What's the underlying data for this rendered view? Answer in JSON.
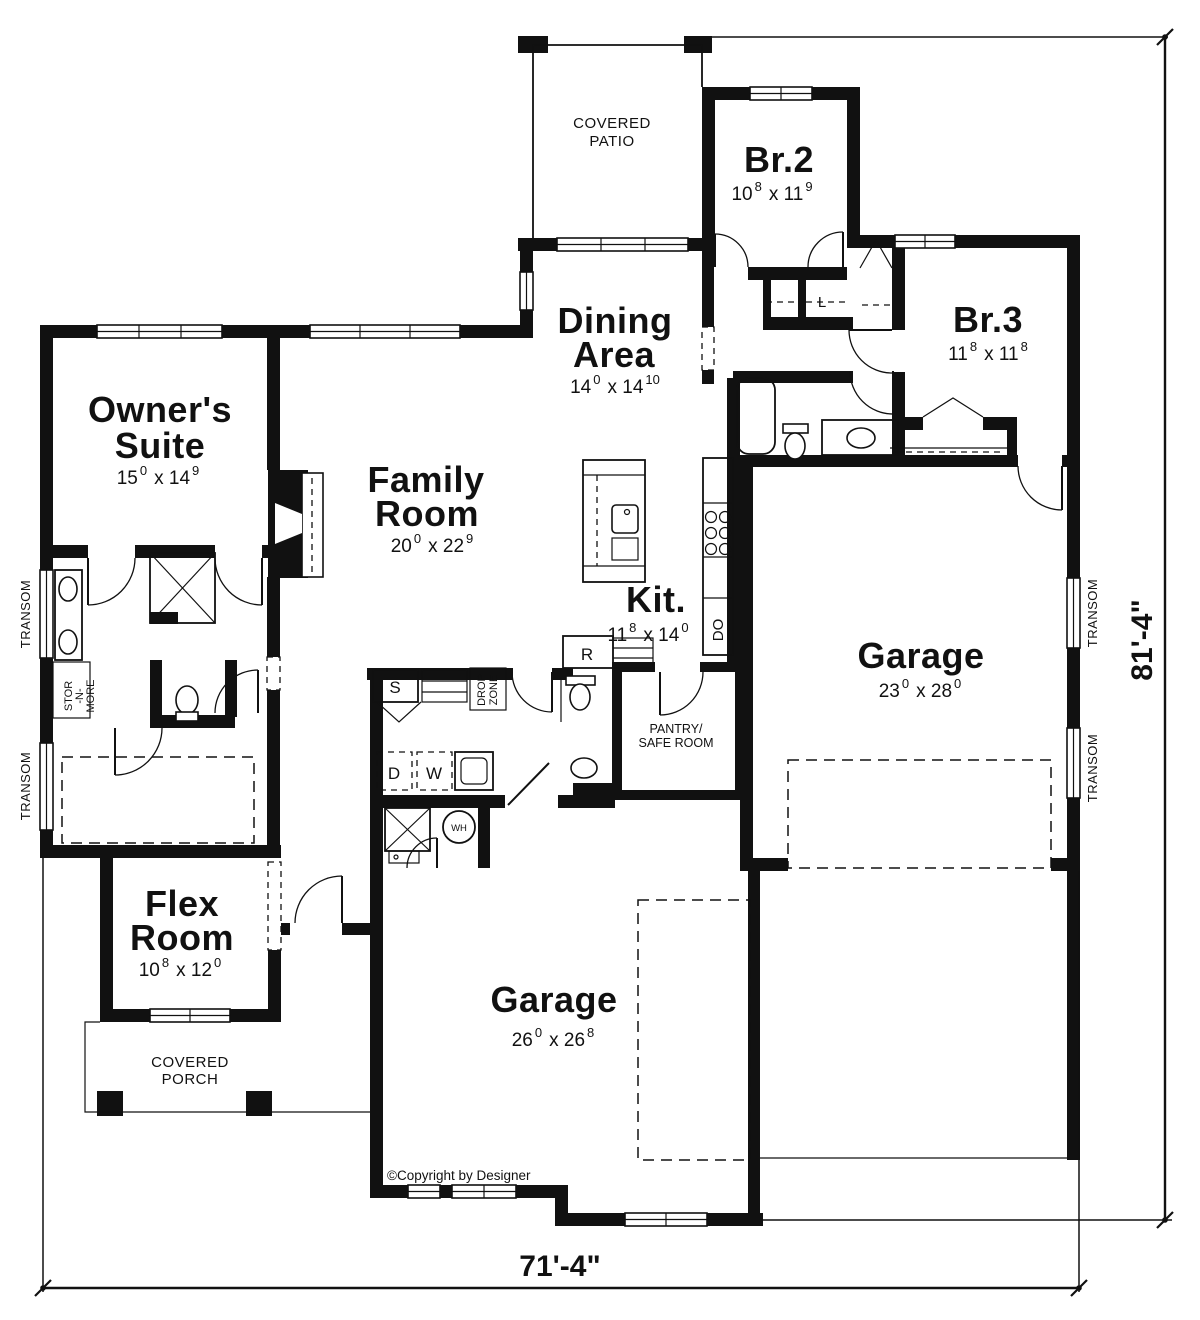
{
  "rooms": {
    "owners_suite": {
      "name": [
        "Owner's",
        "Suite"
      ],
      "ft1": "15",
      "in1": "0",
      "ft2": "x 14",
      "in2": "9"
    },
    "family_room": {
      "name": [
        "Family",
        "Room"
      ],
      "ft1": "20",
      "in1": "0",
      "ft2": "x 22",
      "in2": "9"
    },
    "dining_area": {
      "name": [
        "Dining",
        "Area"
      ],
      "ft1": "14",
      "in1": "0",
      "ft2": "x 14",
      "in2": "10"
    },
    "kitchen": {
      "name": [
        "Kit."
      ],
      "ft1": "11",
      "in1": "8",
      "ft2": "x 14",
      "in2": "0"
    },
    "br2": {
      "name": [
        "Br.2"
      ],
      "ft1": "10",
      "in1": "8",
      "ft2": "x 11",
      "in2": "9"
    },
    "br3": {
      "name": [
        "Br.3"
      ],
      "ft1": "11",
      "in1": "8",
      "ft2": "x 11",
      "in2": "8"
    },
    "garage_rear": {
      "name": [
        "Garage"
      ],
      "ft1": "23",
      "in1": "0",
      "ft2": "x 28",
      "in2": "0"
    },
    "garage_front": {
      "name": [
        "Garage"
      ],
      "ft1": "26",
      "in1": "0",
      "ft2": "x 26",
      "in2": "8"
    },
    "flex_room": {
      "name": [
        "Flex",
        "Room"
      ],
      "ft1": "10",
      "in1": "8",
      "ft2": "x 12",
      "in2": "0"
    }
  },
  "areas": {
    "covered_patio": [
      "COVERED",
      "PATIO"
    ],
    "covered_porch": [
      "COVERED",
      "PORCH"
    ],
    "pantry_safe_room": [
      "PANTRY/",
      "SAFE ROOM"
    ]
  },
  "labels": {
    "transom": "TRANSOM",
    "stor_n_more": [
      "STOR",
      "-N-",
      "MORE"
    ],
    "drop_zone": [
      "DROP",
      "ZONE"
    ],
    "do": "DO",
    "l": "L",
    "s": "S",
    "d": "D",
    "w": "W",
    "r": "R",
    "wh": "WH"
  },
  "dimensions": {
    "width": "71'-4\"",
    "height": "81'-4\""
  },
  "copyright": "©Copyright by Designer"
}
